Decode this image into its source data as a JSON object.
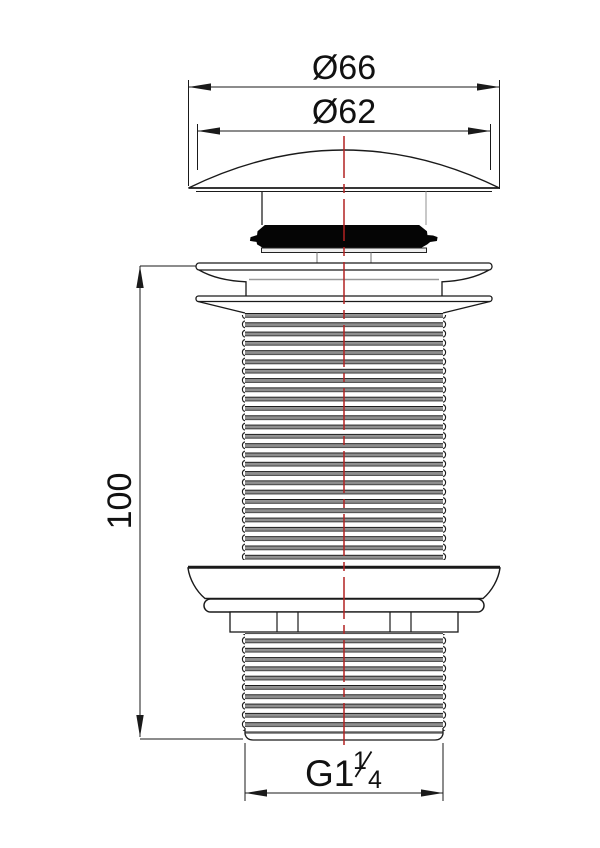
{
  "drawing": {
    "type": "technical-drawing-basin-waste",
    "dimensions": {
      "outer_diameter": "Ø66",
      "inner_diameter": "Ø62",
      "height": "100",
      "thread": {
        "prefix": "G1",
        "numerator": "1",
        "denominator": "4"
      }
    },
    "colors": {
      "line": "#1a1a1a",
      "centerline": "#b22222",
      "thread_shade": "#8f8f8f",
      "light_edge": "#999999"
    }
  }
}
